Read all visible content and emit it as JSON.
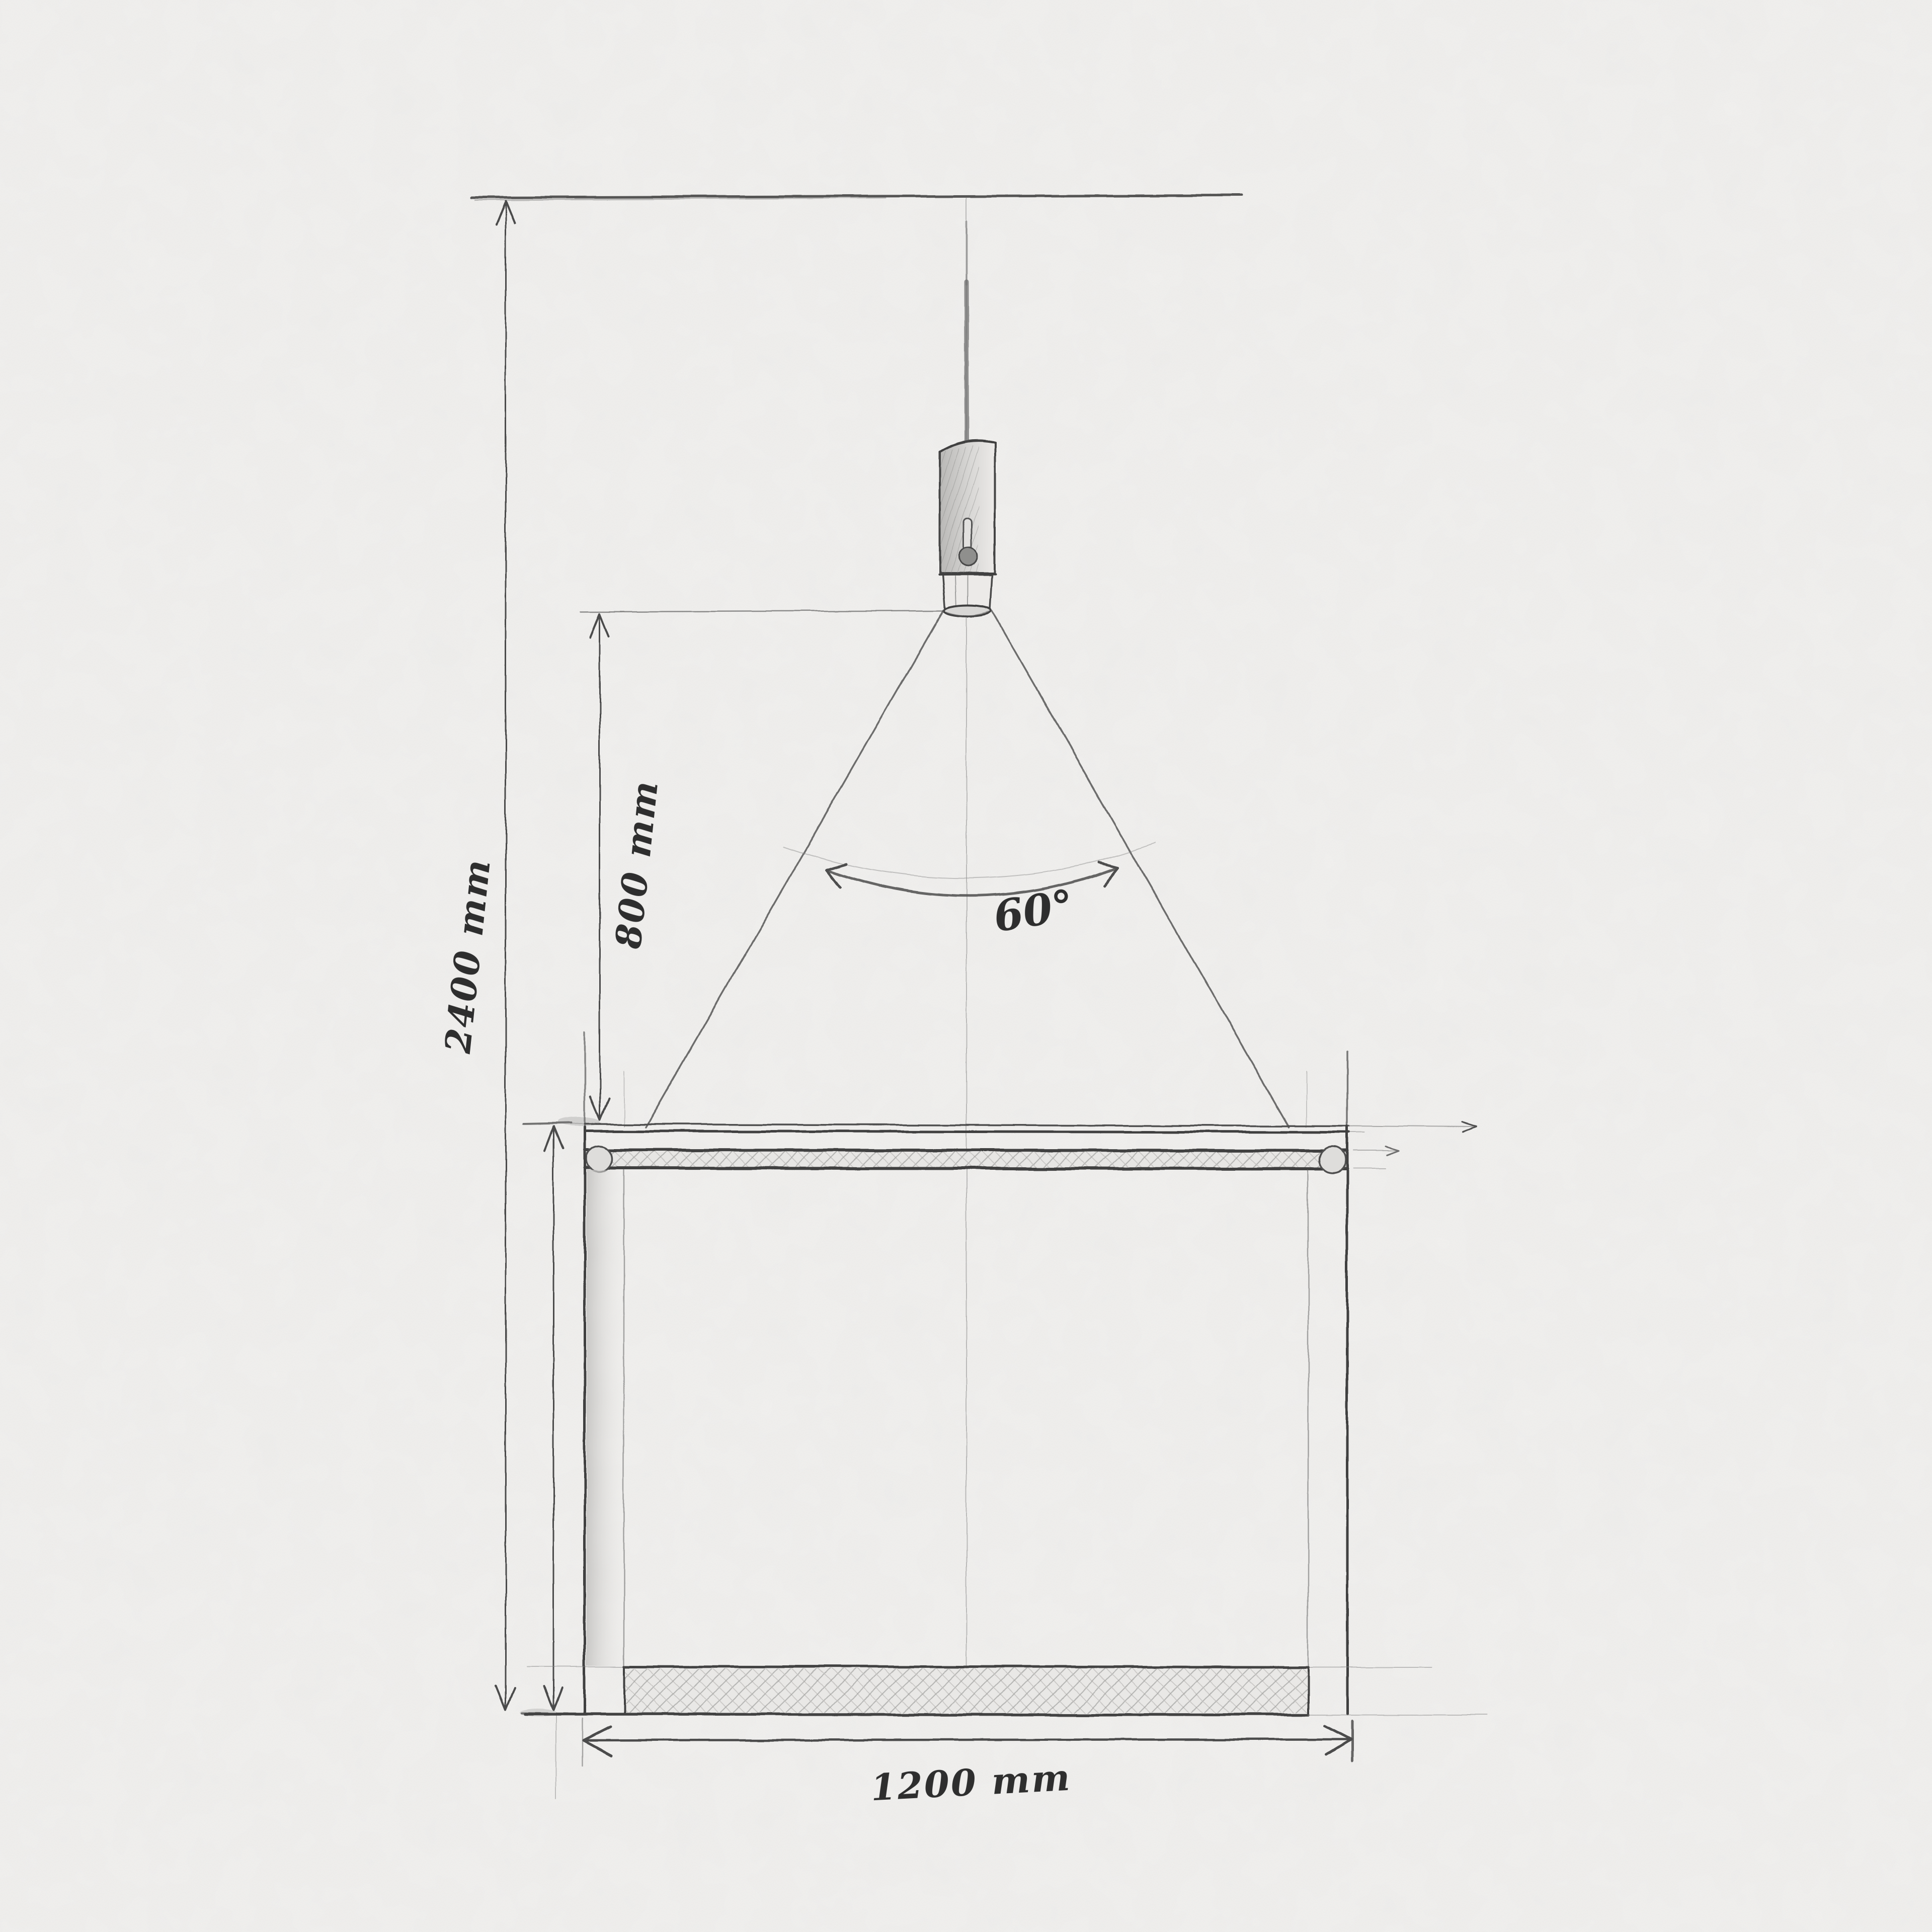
{
  "document": {
    "type": "hand-drawn pencil sketch on textured paper",
    "subject": "Front elevation: pendant lamp with 60-degree light cone hung above a table"
  },
  "dimensions": {
    "overall_height": {
      "label": "2400 mm",
      "meaning": "ceiling to floor"
    },
    "lamp_to_table": {
      "label": "800 mm",
      "meaning": "lamp bottom to tabletop"
    },
    "beam_angle": {
      "label": "60°",
      "meaning": "light cone angle"
    },
    "table_width": {
      "label": "1200 mm",
      "meaning": "table width"
    }
  },
  "colors": {
    "paper": "#f4f3f1",
    "graphite_dark": "#3f3f3f",
    "graphite_mid": "#6b6b6b",
    "graphite_light": "#9a9a9a",
    "shade_fill": "#c9c8c6"
  }
}
